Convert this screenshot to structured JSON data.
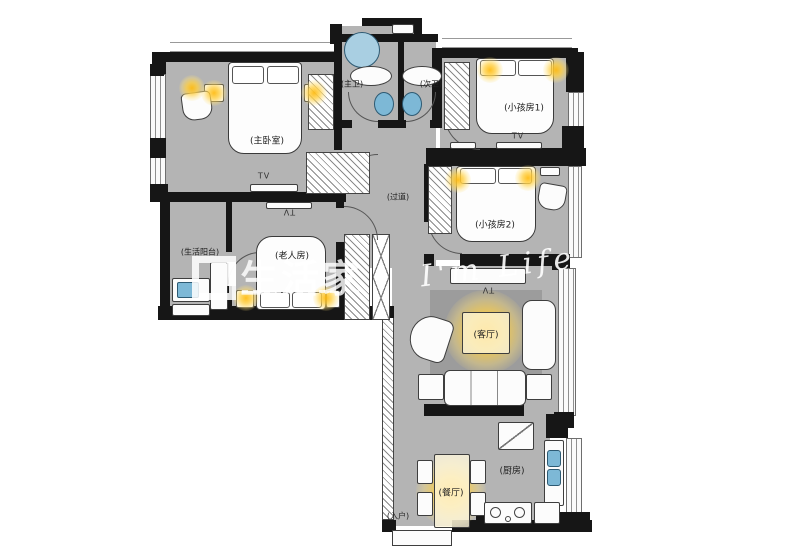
{
  "plan": {
    "rooms": [
      {
        "key": "master-bedroom",
        "label": "(主卧室)"
      },
      {
        "key": "master-bath",
        "label": "(主卫)"
      },
      {
        "key": "second-bath",
        "label": "(次卫)"
      },
      {
        "key": "kids-room-1",
        "label": "(小孩房1)"
      },
      {
        "key": "hallway",
        "label": "(过道)"
      },
      {
        "key": "kids-room-2",
        "label": "(小孩房2)"
      },
      {
        "key": "utility-balcony",
        "label": "(生活阳台)"
      },
      {
        "key": "elder-room",
        "label": "(老人房)"
      },
      {
        "key": "living-room",
        "label": "(客厅)"
      },
      {
        "key": "dining-room",
        "label": "(餐厅)"
      },
      {
        "key": "kitchen",
        "label": "(厨房)"
      },
      {
        "key": "entry",
        "label": "(入户)"
      }
    ],
    "tv_label": "TV",
    "colors": {
      "floor": "#b4b4b4",
      "rug": "#9c9c9c",
      "wall": "#161616",
      "light_glow": "#ffc814",
      "fixture_blue": "#7db8d6"
    }
  },
  "watermark": {
    "logo_text": "生活家",
    "script_text": "I'm Life"
  }
}
